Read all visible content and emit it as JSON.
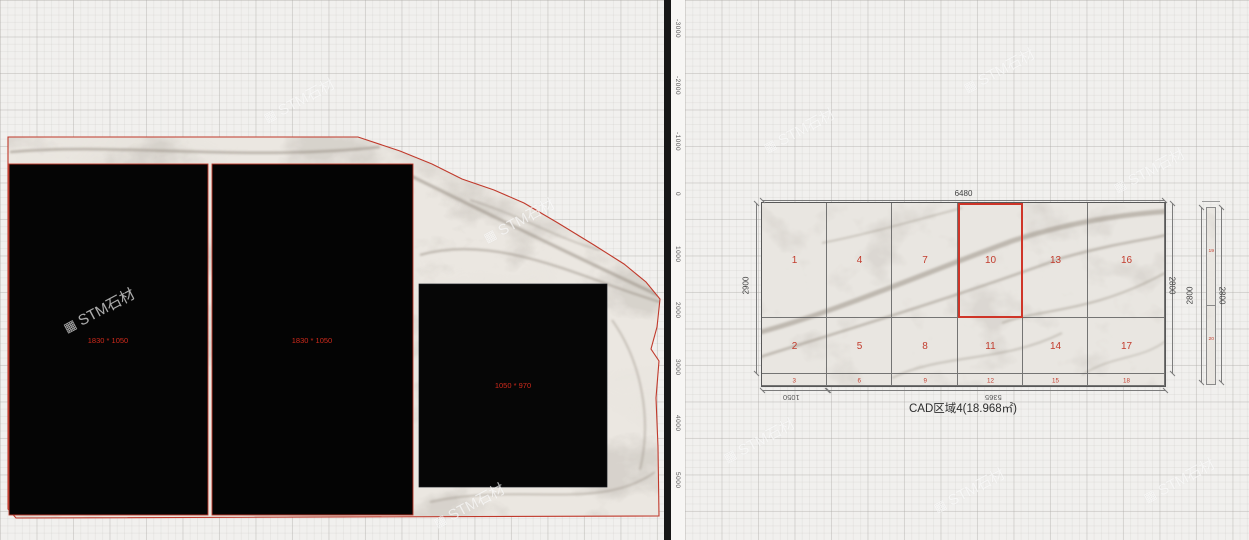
{
  "colors": {
    "accent_red": "#c0392b",
    "piece_label_red": "#cf2a1c",
    "tile_number_red": "#c23b2c",
    "line_gray": "#6e6e6e"
  },
  "left_viewport": {
    "pieces": [
      {
        "size_label": "1830 * 1050"
      },
      {
        "size_label": "1830 * 1050"
      },
      {
        "size_label": "1050 * 970"
      }
    ]
  },
  "ruler": {
    "ticks": [
      "-3000",
      "-2000",
      "-1000",
      "0",
      "1000",
      "2000",
      "3000",
      "4000",
      "5000"
    ]
  },
  "cad": {
    "caption": "CAD区域4(18.968㎡)",
    "dims": {
      "top": "6480",
      "left": "2900",
      "right": "2800",
      "bottom_left": "1050",
      "bottom_right": "5365"
    },
    "tiles": {
      "row1": [
        "1",
        "4",
        "7",
        "10",
        "13",
        "16"
      ],
      "row2": [
        "2",
        "5",
        "8",
        "11",
        "14",
        "17"
      ],
      "row3": [
        "3",
        "6",
        "9",
        "12",
        "15",
        "18"
      ],
      "selected": "10"
    },
    "side_strip": {
      "dim_left": "2800",
      "dim_right": "2800",
      "top_number": "19",
      "bottom_number": "20"
    }
  },
  "watermark": {
    "icon": "▦",
    "text": "STM石材"
  }
}
